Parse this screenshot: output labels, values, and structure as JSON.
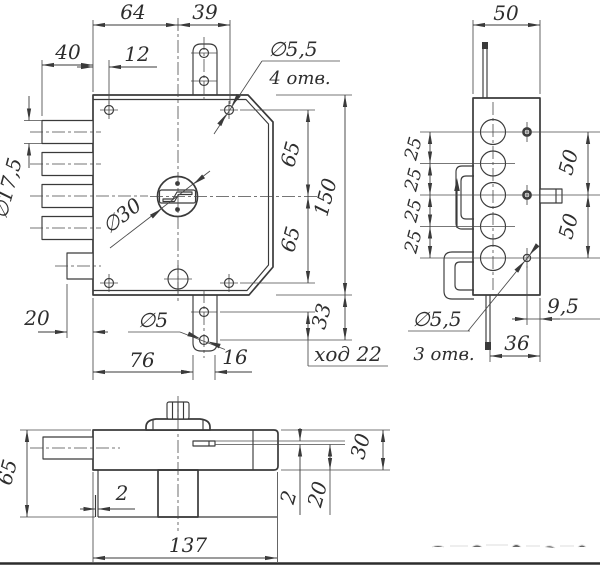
{
  "meta": {
    "title": "lock-technical-drawing",
    "background": "#ffffff",
    "line_color": "#3a3a3a"
  },
  "front_view": {
    "dim_64": "64",
    "dim_39": "39",
    "dim_40": "40",
    "dim_12": "12",
    "holes_top_diameter": "∅5,5",
    "holes_top_count": "4 отв.",
    "bolt_diameter": "∅17,5",
    "cylinder_diameter": "∅30",
    "dim_65_upper": "65",
    "dim_150": "150",
    "dim_65_lower": "65",
    "dim_33": "33",
    "stroke_label": "ход 22",
    "dim_20": "20",
    "tab_hole_diameter": "∅5",
    "dim_76": "76",
    "dim_16": "16"
  },
  "side_view": {
    "dim_50_top": "50",
    "dim_25_1": "25",
    "dim_25_2": "25",
    "dim_25_3": "25",
    "dim_25_4": "25",
    "dim_50_right_upper": "50",
    "dim_50_right_lower": "50",
    "dim_9_5": "9,5",
    "dim_36": "36",
    "holes_diameter": "∅5,5",
    "holes_count": "3 отв."
  },
  "bottom_view": {
    "dim_65": "65",
    "dim_2_left": "2",
    "dim_137": "137",
    "dim_2_right": "2",
    "dim_20": "20",
    "dim_30": "30"
  }
}
